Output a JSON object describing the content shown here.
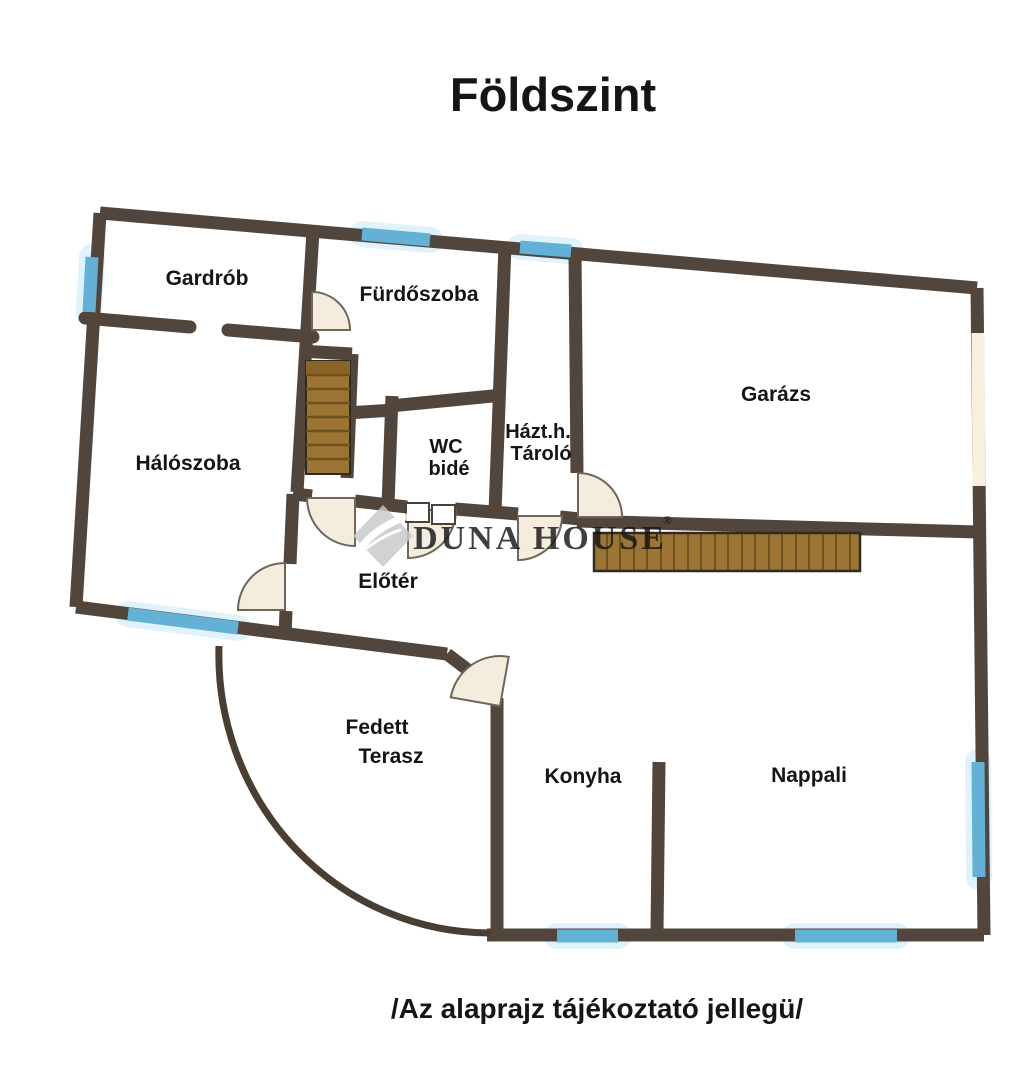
{
  "title": "Földszint",
  "footer": "/Az alaprajz tájékoztató jellegü/",
  "watermark": {
    "brand": "DUNA HOUSE",
    "registered": "®"
  },
  "rooms": {
    "gardrob": "Gardrób",
    "furdoszoba": "Fürdőszoba",
    "garazs": "Garázs",
    "haloszoba": "Hálószoba",
    "wc_line1": "WC",
    "wc_line2": "bidé",
    "tarolo_line1": "Házt.h.",
    "tarolo_line2": "Tároló",
    "eloter": "Előtér",
    "terasz_line1": "Fedett",
    "terasz_line2": "Terasz",
    "konyha": "Konyha",
    "nappali": "Nappali"
  },
  "colors": {
    "background": "#ffffff",
    "wall": "#52453b",
    "window": "#63b1d7",
    "window_glow": "#c6e8f7",
    "stairs": "#9c7433",
    "stairs_line": "#6f511f",
    "stairs_first_tread": "#8a6426",
    "door_fill": "#f4ecdc",
    "garage_door": "#f7f0df",
    "watermark_gray": "#c2c2c2",
    "text": "#151515"
  }
}
